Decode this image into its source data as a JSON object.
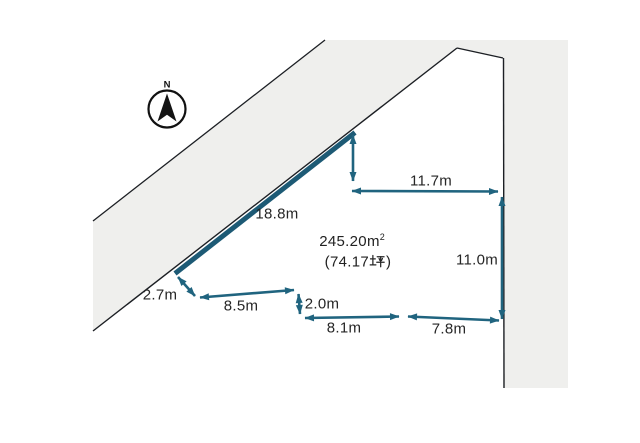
{
  "diagram": {
    "kind": "land-plot-survey-figure",
    "compass": {
      "north_label": "N"
    },
    "area": {
      "m2_text": "245.20㎡",
      "m2_value": "245.20",
      "m2_unit_base": "m",
      "m2_unit_exponent": "2",
      "tsubo_text": "（74.17坪）",
      "tsubo_display_prefix": "(74.17",
      "tsubo_display_suffix": ")"
    },
    "dimensions": [
      {
        "edge": "northwest-road-frontage",
        "label": "18.8m"
      },
      {
        "edge": "north-upper-width",
        "label": "11.7m"
      },
      {
        "edge": "east-boundary",
        "label": "11.0m"
      },
      {
        "edge": "west-step",
        "label": "2.7m"
      },
      {
        "edge": "south-segment-west",
        "label": "8.5m"
      },
      {
        "edge": "south-step",
        "label": "2.0m"
      },
      {
        "edge": "south-segment-middle",
        "label": "8.1m"
      },
      {
        "edge": "south-segment-east",
        "label": "7.8m"
      }
    ],
    "colors": {
      "dimension_teal": "#20647f",
      "frontage_teal": "#1d5a75",
      "boundary_black": "#1c1f24",
      "road_fill": "#efefed",
      "background": "#ffffff"
    }
  }
}
